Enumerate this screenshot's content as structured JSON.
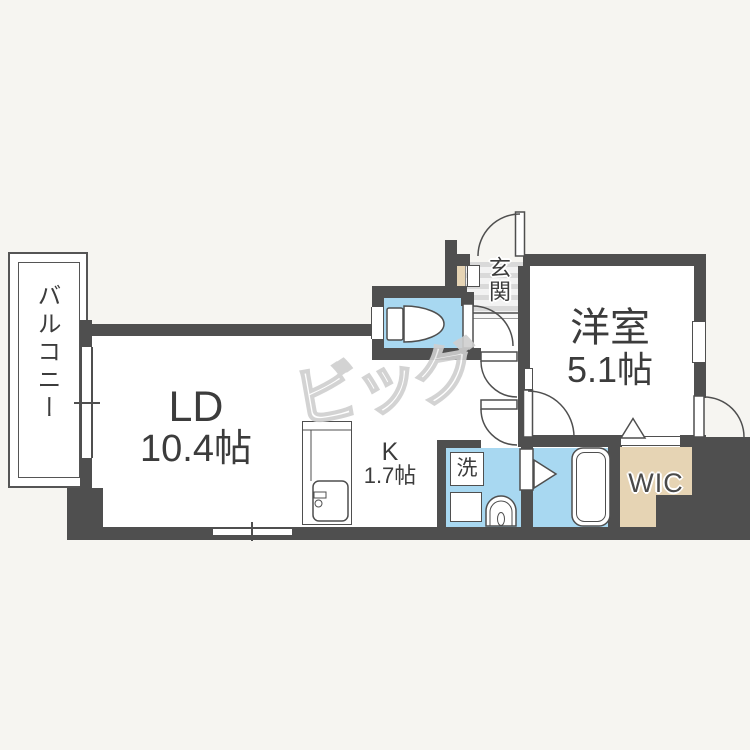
{
  "floorplan": {
    "balcony": {
      "label": "バルコニー"
    },
    "living_dining": {
      "label": "LD",
      "size": "10.4帖"
    },
    "kitchen": {
      "label": "K",
      "size": "1.7帖"
    },
    "entrance": {
      "label": "玄関"
    },
    "western_room": {
      "label": "洋室",
      "size": "5.1帖"
    },
    "walk_in_closet": {
      "label": "WIC"
    },
    "laundry": {
      "label": "洗"
    },
    "watermark": {
      "text": "ビッグ"
    },
    "colors": {
      "wall": "#4f4f4f",
      "water_area": "#a8d8f1",
      "closet": "#e6d4b4",
      "background": "#f6f5f1"
    }
  }
}
